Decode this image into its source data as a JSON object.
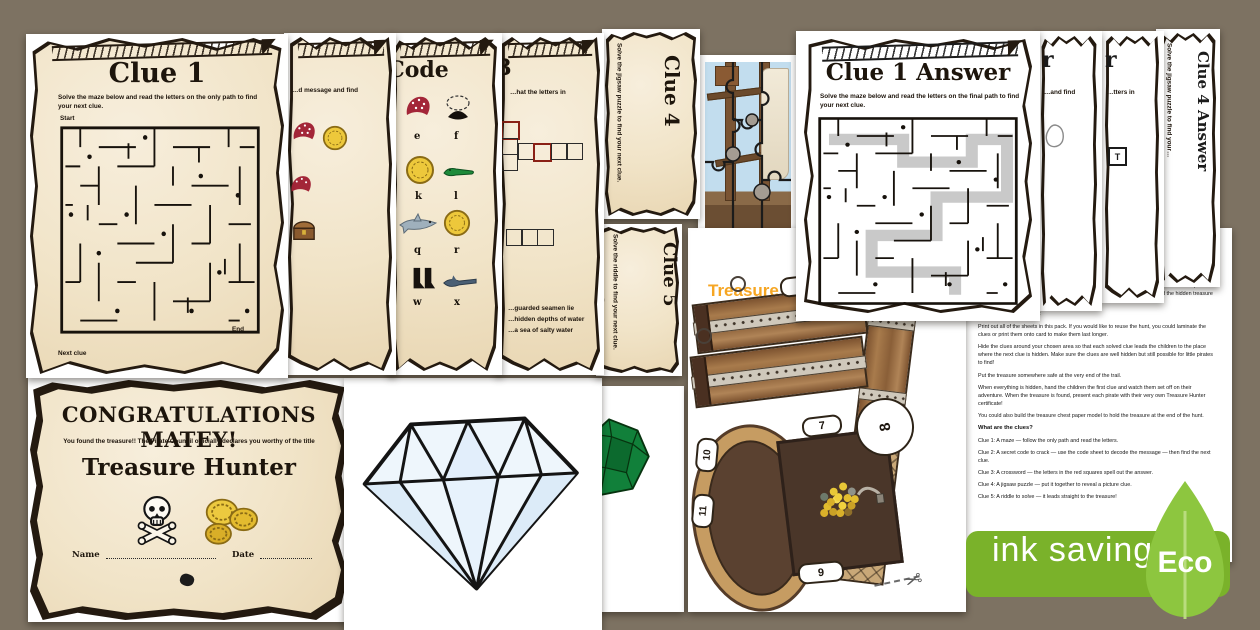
{
  "sheets": {
    "clue1": {
      "title": "Clue 1",
      "instructions": "Solve the maze below and read the letters on the only path to find your next clue.",
      "start_label": "Start",
      "end_label": "End",
      "footer_label": "Next clue"
    },
    "clue2": {
      "snippet": "…d message and find"
    },
    "code": {
      "title": "Code",
      "letters": [
        "e",
        "f",
        "k",
        "l",
        "q",
        "r",
        "w",
        "x"
      ]
    },
    "clue3": {
      "number": "3",
      "snippet": "…hat the letters in",
      "riddle_lines": [
        "…guarded seamen lie",
        "…hidden depths of water",
        "…a sea of salty water"
      ]
    },
    "clue4": {
      "title": "Clue 4",
      "instructions": "Solve the jigsaw puzzle to find your next clue."
    },
    "clue5": {
      "title": "Clue 5",
      "instructions": "Solve the riddle to find your next clue."
    },
    "clue1_answer": {
      "title": "Clue 1 Answer",
      "instructions": "Solve the maze below and read the letters on the final path to find your next clue."
    },
    "clue2_answer": {
      "title_fragment": "r",
      "snippet": "…and find"
    },
    "clue3_answer": {
      "title_fragment": "r",
      "snippet": "…tters in",
      "letter_box": "T"
    },
    "clue4_answer": {
      "title": "Clue 4 Answer",
      "instructions": "Solve the jigsaw puzzle to find your…"
    }
  },
  "chest_model": {
    "title_line1": "Treasure Chest",
    "title_line2": "Paper Model",
    "tabs": {
      "t1": "1",
      "t2": "2",
      "t6": "6",
      "t7": "7",
      "t8": "8",
      "t9": "9",
      "t10": "10",
      "t11": "11"
    },
    "scissors_icon": "✂"
  },
  "organiser": {
    "title": "Pirate Treasure Hunt",
    "subtitle": "Instructions for Organisers",
    "p1": "Set up this pirate treasure hunt around the home, garden or classroom and watch the little pirates put their problem-solving skills to the test as they follow the trail of clues to find the hidden treasure at the end.",
    "h_setup": "How to set up the hunt",
    "p2": "Print out all of the sheets in this pack. If you would like to reuse the hunt, you could laminate the clues or print them onto card to make them last longer.",
    "p3": "Hide the clues around your chosen area so that each solved clue leads the children to the place where the next clue is hidden. Make sure the clues are well hidden but still possible for little pirates to find!",
    "p4": "Put the treasure somewhere safe at the very end of the trail.",
    "p5": "When everything is hidden, hand the children the first clue and watch them set off on their adventure. When the treasure is found, present each pirate with their very own Treasure Hunter certificate!",
    "p6": "You could also build the treasure chest paper model to hold the treasure at the end of the hunt.",
    "h_clues": "What are the clues?",
    "clues": [
      "Clue 1: A maze — follow the only path and read the letters.",
      "Clue 2: A secret code to crack — use the code sheet to decode the message — then find the next clue.",
      "Clue 3: A crossword — the letters in the red squares spell out the answer.",
      "Clue 4: A jigsaw puzzle — put it together to reveal a picture clue.",
      "Clue 5: A riddle to solve — it leads straight to the treasure!"
    ]
  },
  "certificate": {
    "title": "CONGRATULATIONS MATEY!",
    "subtitle": "You found the treasure!! The Pirate Council officially declares you worthy of the title",
    "award": "Treasure Hunter",
    "name_label": "Name",
    "date_label": "Date"
  },
  "badge": {
    "label": "ink saving",
    "eco_label": "Eco"
  },
  "colors": {
    "accent_orange": "#f6a623",
    "badge_green": "#7ab22a",
    "leaf_green": "#8dc63f",
    "parchment": "#f1e4c8"
  }
}
